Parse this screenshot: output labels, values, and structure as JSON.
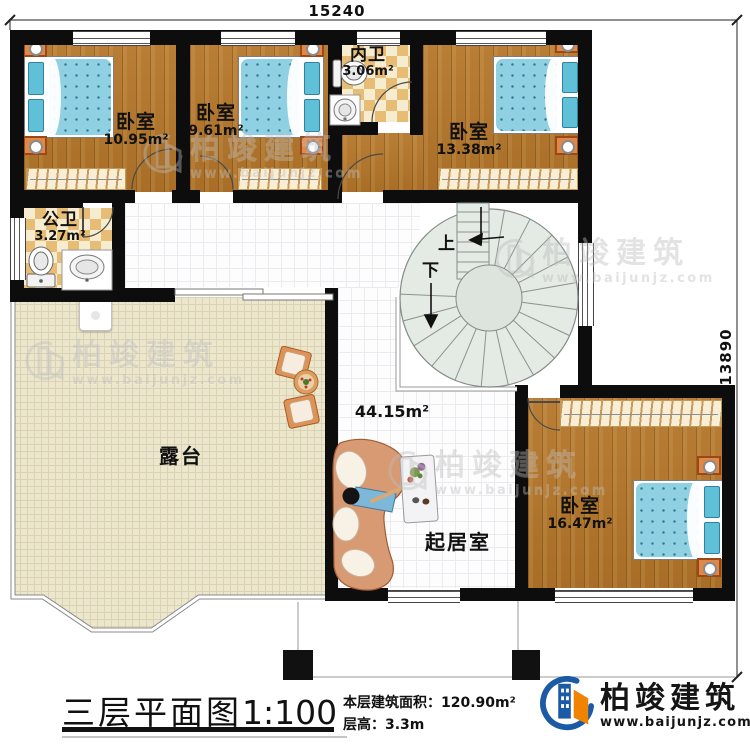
{
  "dimensions": {
    "width_top": "15240",
    "height_right": "13890"
  },
  "rooms": {
    "bedroom_tl": {
      "name": "卧室",
      "area": "10.95m²"
    },
    "bedroom_tm": {
      "name": "卧室",
      "area": "9.61m²"
    },
    "bedroom_tr": {
      "name": "卧室",
      "area": "13.38m²"
    },
    "bedroom_br": {
      "name": "卧室",
      "area": "16.47m²"
    },
    "bath_inner": {
      "name": "内卫",
      "area": "3.06m²"
    },
    "bath_public": {
      "name": "公卫",
      "area": "3.27m²"
    },
    "terrace": {
      "name": "露台"
    },
    "living": {
      "name": "起居室",
      "area": "44.15m²"
    }
  },
  "stairs": {
    "up_label": "上",
    "down_label": "下"
  },
  "title": {
    "text": "三层平面图",
    "scale": "1:100"
  },
  "stats": {
    "area_label": "本层建筑面积：",
    "area_value": "120.90m²",
    "floor_height_label": "层高：",
    "floor_height_value": "3.3m"
  },
  "brand": {
    "name": "柏竣建筑",
    "website": "www.baijunjz.com"
  },
  "watermark": {
    "name": "柏竣建筑",
    "website": "www.baijunjz.com"
  },
  "colors": {
    "wall": "#0d0d0d",
    "wood": "#b1762f",
    "tile": "#fdfdfd",
    "terrace": "#ece6cd",
    "checker": "#e7bd76",
    "mattress": "#8fd0e2",
    "stair": "#e4eae4",
    "brand_blue": "#1b5aa5",
    "brand_orange": "#f08300"
  }
}
